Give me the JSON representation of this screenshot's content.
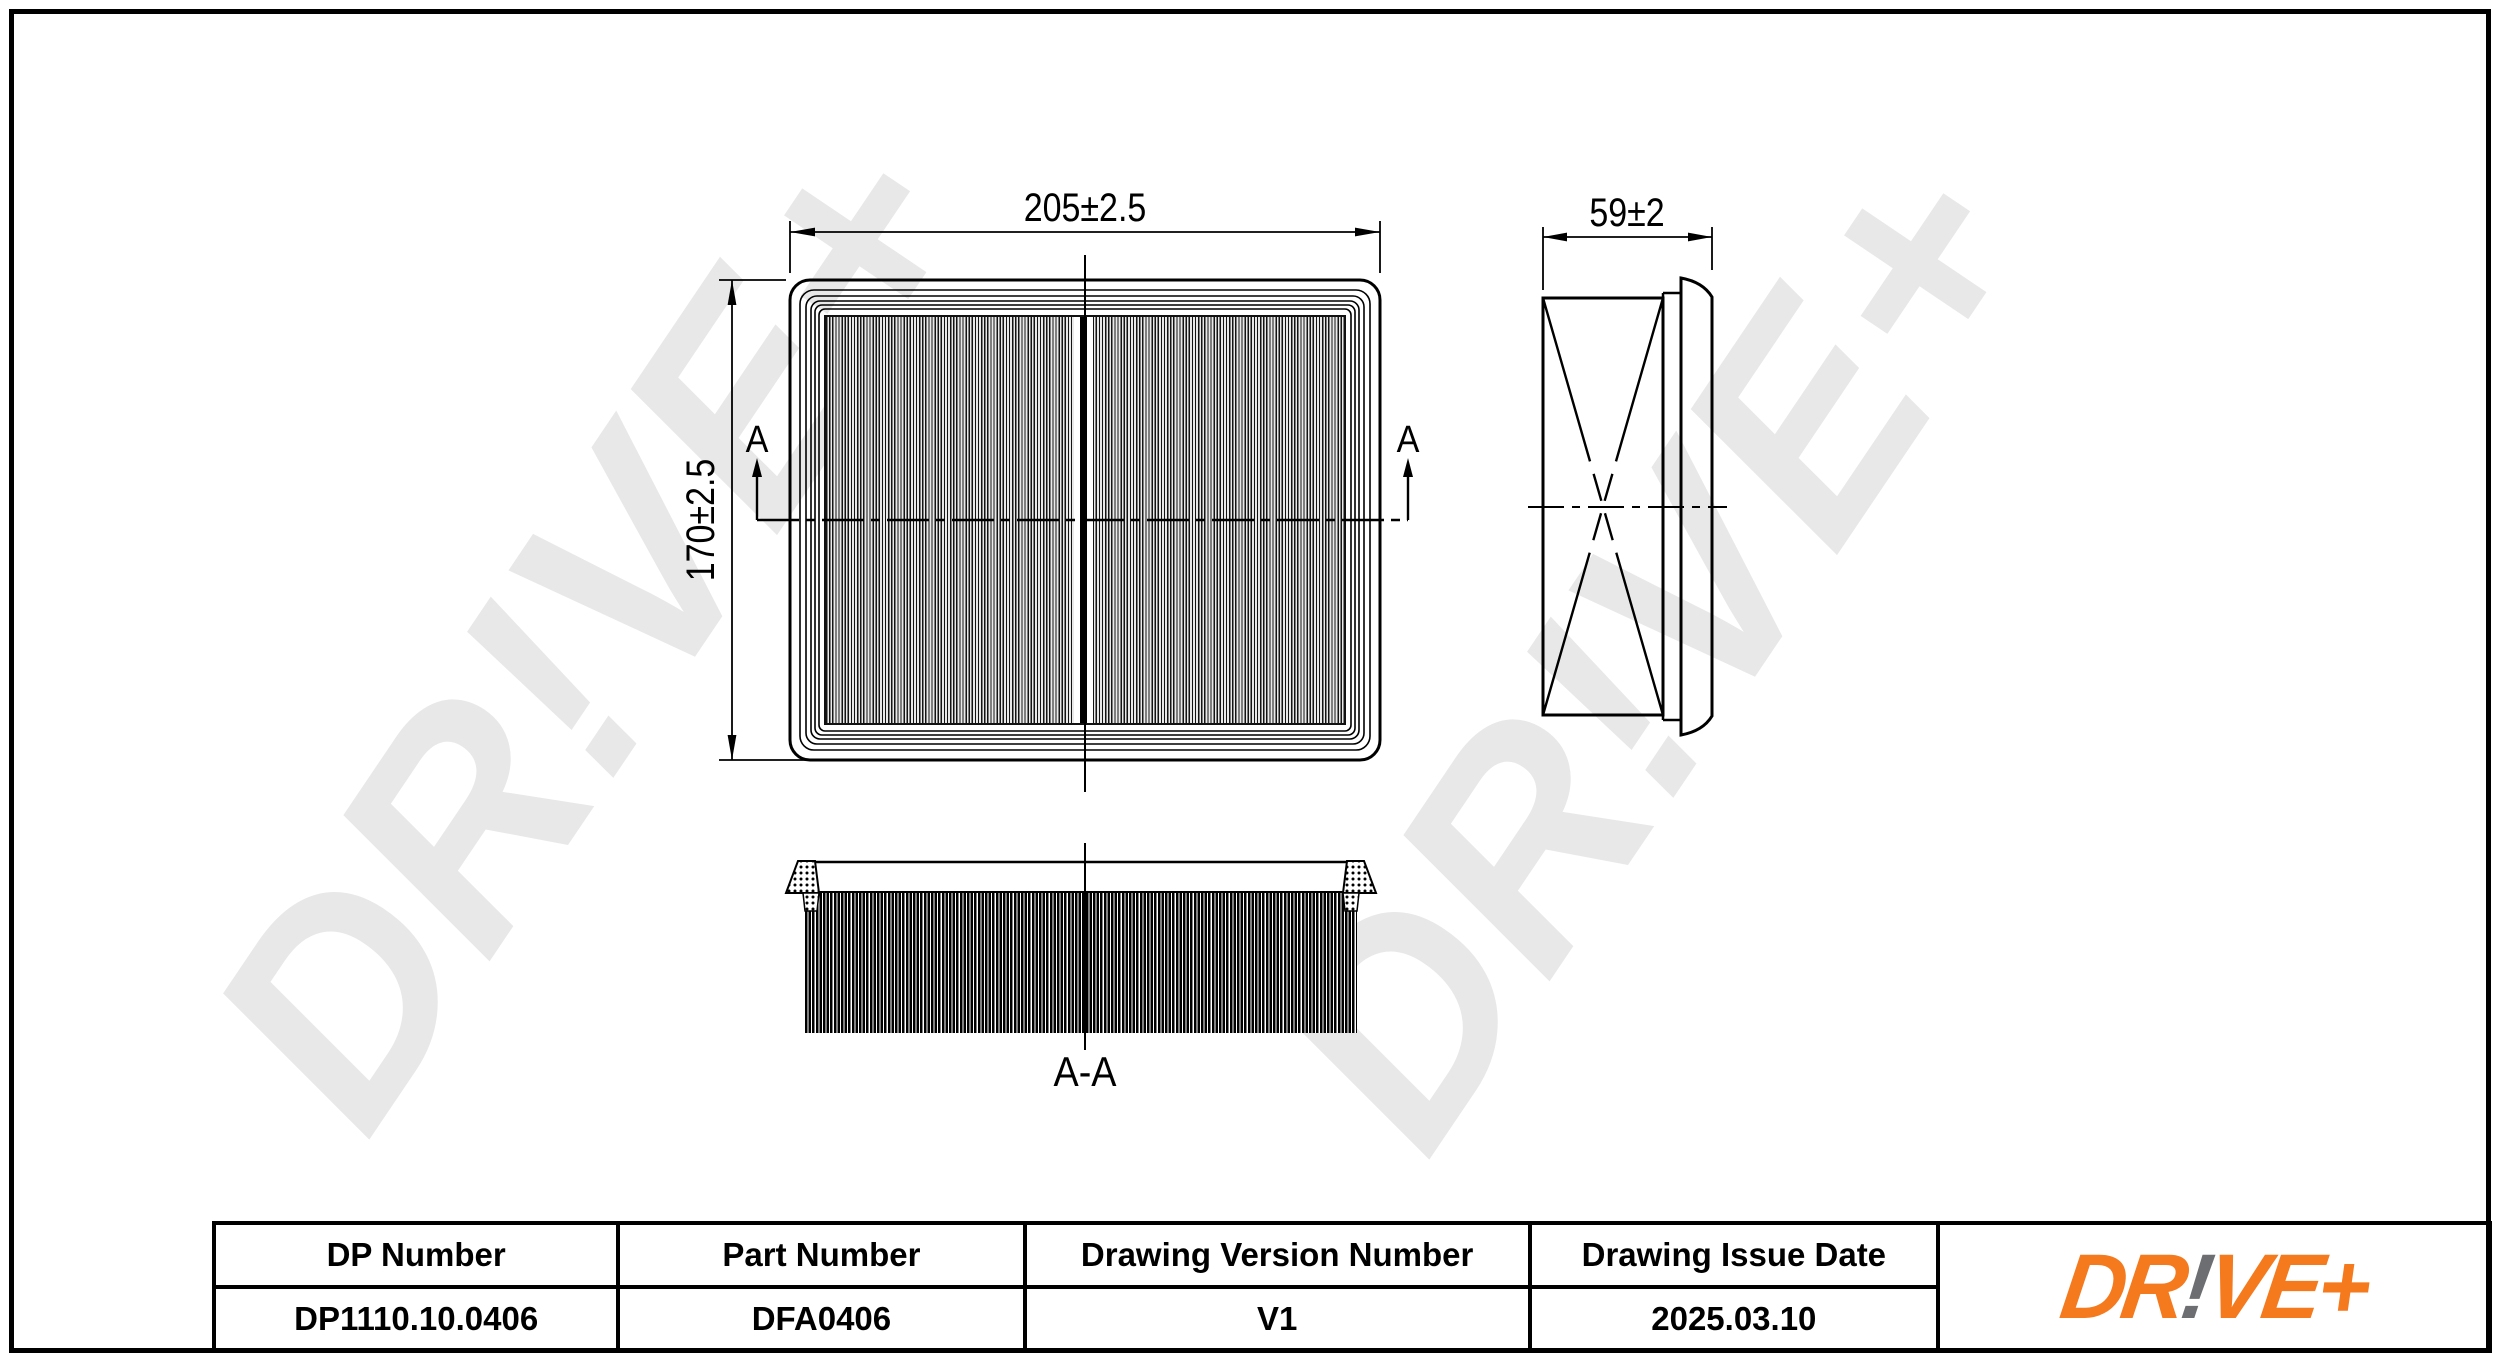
{
  "watermark": {
    "text": "DR!VE+"
  },
  "drawing": {
    "plan_view": {
      "width_dim": "205±2.5",
      "height_dim": "170±2.5",
      "section_arrow_label_left": "A",
      "section_arrow_label_right": "A"
    },
    "side_view": {
      "width_dim": "59±2"
    },
    "section_view": {
      "label": "A-A"
    }
  },
  "title_block": {
    "columns": [
      {
        "header": "DP Number",
        "value": "DP1110.10.0406"
      },
      {
        "header": "Part Number",
        "value": "DFA0406"
      },
      {
        "header": "Drawing Version Number",
        "value": "V1"
      },
      {
        "header": "Drawing Issue Date",
        "value": "2025.03.10"
      }
    ]
  },
  "logo": {
    "segment_dr": "DR",
    "segment_exclamation": "!",
    "segment_ve_plus": "VE+",
    "color_orange": "#F5791D",
    "color_gray": "#6D6E71"
  },
  "colors": {
    "line": "#000000",
    "watermark": "#E8E8E8",
    "background": "#FFFFFF"
  }
}
